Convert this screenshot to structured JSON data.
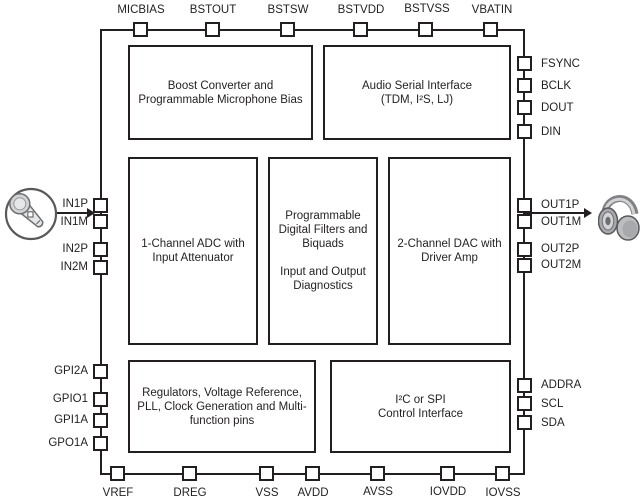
{
  "diagram_title": "Audio codec functional block diagram",
  "colors": {
    "line": "#231f20",
    "icon_gray": "#808285",
    "background": "#ffffff"
  },
  "pins": {
    "top": [
      "MICBIAS",
      "BSTOUT",
      "BSTSW",
      "BSTVDD",
      "BSTVSS",
      "VBATIN"
    ],
    "bottom": [
      "VREF",
      "DREG",
      "VSS",
      "AVDD",
      "AVSS",
      "IOVDD",
      "IOVSS"
    ],
    "left": [
      "IN1P",
      "IN1M",
      "IN2P",
      "IN2M",
      "GPI2A",
      "GPIO1",
      "GPI1A",
      "GPO1A"
    ],
    "right": [
      "FSYNC",
      "BCLK",
      "DOUT",
      "DIN",
      "OUT1P",
      "OUT1M",
      "OUT2P",
      "OUT2M",
      "ADDRA",
      "SCL",
      "SDA"
    ]
  },
  "blocks": {
    "boost": "Boost Converter and\nProgrammable Microphone Bias",
    "audio_serial": "Audio Serial Interface\n(TDM, I²S, LJ)",
    "adc": "1-Channel ADC with\nInput Attenuator",
    "filters": "Programmable\nDigital Filters and\nBiquads\n\nInput and Output\nDiagnostics",
    "dac": "2-Channel DAC with\nDriver Amp",
    "regulators": "Regulators, Voltage Reference,\nPLL, Clock Generation and Multi-\nfunction pins",
    "control": "I²C or SPI\nControl Interface"
  },
  "icons": {
    "input_source": "microphone",
    "output_load": "headphones"
  }
}
